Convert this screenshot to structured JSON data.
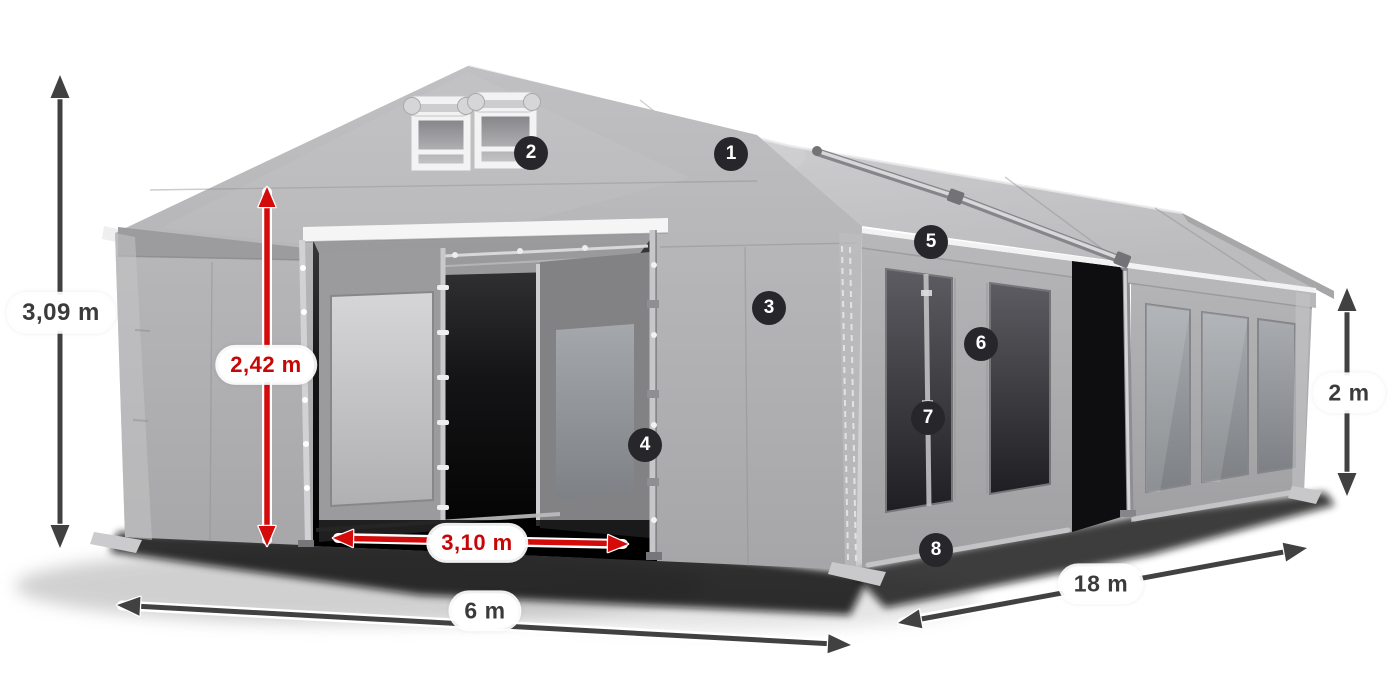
{
  "illustration": {
    "name": "marquee-tent-3d-diagram"
  },
  "dimensions": {
    "ridge_height": {
      "label": "3,09 m",
      "style": "dark"
    },
    "entrance_height": {
      "label": "2,42 m",
      "style": "red"
    },
    "entrance_width": {
      "label": "3,10 m",
      "style": "red"
    },
    "front_width": {
      "label": "6 m",
      "style": "dark"
    },
    "side_length": {
      "label": "18 m",
      "style": "dark"
    },
    "side_height": {
      "label": "2 m",
      "style": "dark"
    }
  },
  "callouts": [
    {
      "number": "1"
    },
    {
      "number": "2"
    },
    {
      "number": "3"
    },
    {
      "number": "4"
    },
    {
      "number": "5"
    },
    {
      "number": "6"
    },
    {
      "number": "7"
    },
    {
      "number": "8"
    }
  ],
  "colors": {
    "dimension_dark": "#414142",
    "dimension_red": "#d30b0b",
    "badge_background": "#26262b",
    "badge_text": "#ffffff",
    "pill_background": "#ffffff",
    "tent_gray": "#acacae",
    "background": "#ffffff"
  }
}
